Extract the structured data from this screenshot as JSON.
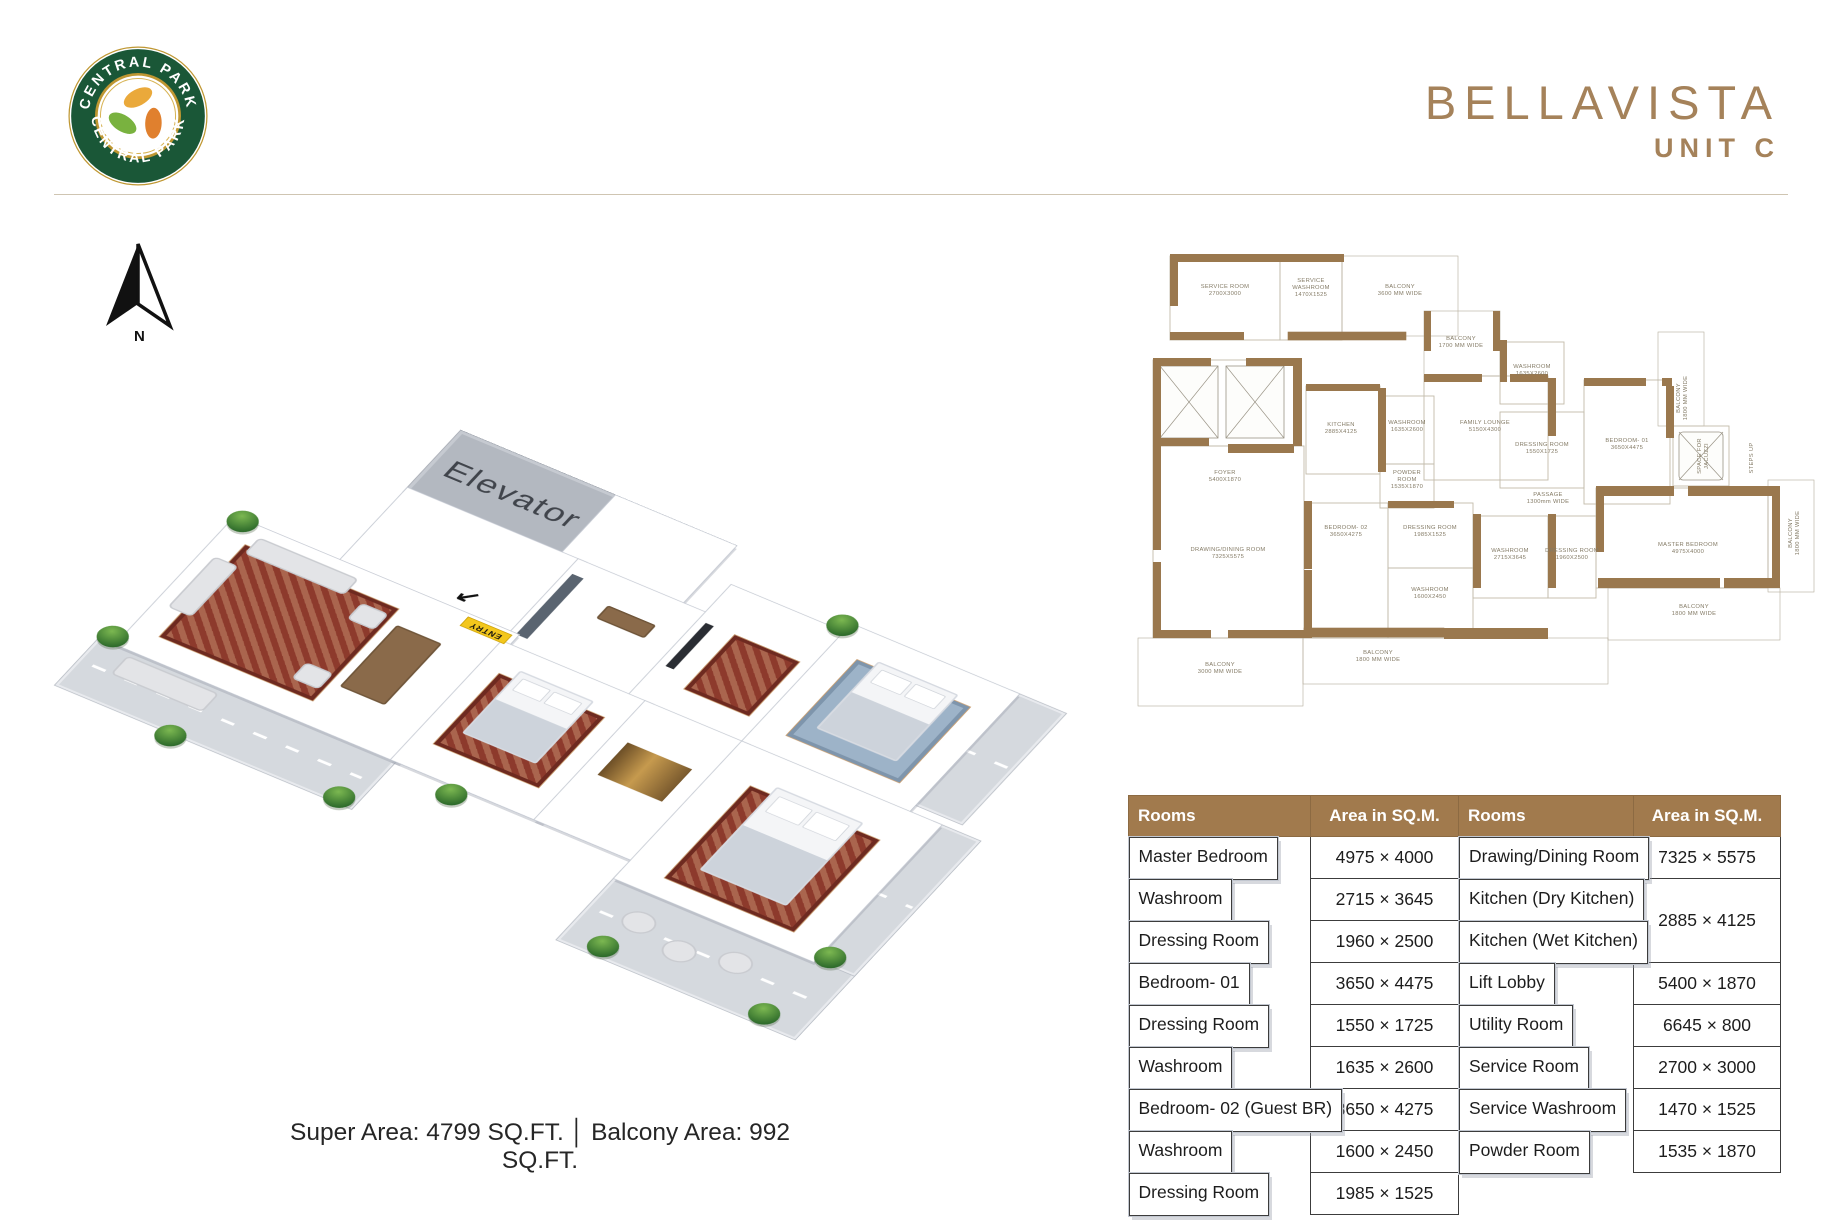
{
  "colors": {
    "accent_tan": "#a5825a",
    "table_header_brown": "#a17a4d",
    "wall_brown": "#9a784e",
    "entry_yellow": "#f3c71c",
    "logo_green": "#1a5737",
    "logo_gold": "#bf9732"
  },
  "brand": {
    "ring_text_top": "CENTRAL PARK",
    "ring_text_bottom": "CENTRAL PARK"
  },
  "header": {
    "title": "BELLAVISTA",
    "subtitle": "UNIT C"
  },
  "compass": {
    "label": "N"
  },
  "iso_plan": {
    "elevator_label": "Elevator",
    "entry_label": "ENTRY",
    "entry_arrow": "↙"
  },
  "floorplan2d": {
    "labels": [
      {
        "lines": [
          "SERVICE ROOM",
          "2700X3000"
        ],
        "x": 97,
        "y": 40
      },
      {
        "lines": [
          "SERVICE",
          "WASHROOM",
          "1470X1525"
        ],
        "x": 183,
        "y": 34
      },
      {
        "lines": [
          "BALCONY",
          "3600 MM WIDE"
        ],
        "x": 272,
        "y": 40
      },
      {
        "lines": [
          "BALCONY",
          "1700 MM WIDE"
        ],
        "x": 333,
        "y": 92
      },
      {
        "lines": [
          "FOYER",
          "5400X1870"
        ],
        "x": 97,
        "y": 226
      },
      {
        "lines": [
          "KITCHEN",
          "2885X4125"
        ],
        "x": 213,
        "y": 178
      },
      {
        "lines": [
          "WASHROOM",
          "1635X2600"
        ],
        "x": 279,
        "y": 176
      },
      {
        "lines": [
          "POWDER",
          "ROOM",
          "1535X1870"
        ],
        "x": 279,
        "y": 226
      },
      {
        "lines": [
          "FAMILY LOUNGE",
          "5150X4300"
        ],
        "x": 357,
        "y": 176
      },
      {
        "lines": [
          "WASHROOM",
          "1635X2600"
        ],
        "x": 404,
        "y": 120
      },
      {
        "lines": [
          "DRESSING ROOM",
          "1550X1725"
        ],
        "x": 414,
        "y": 198
      },
      {
        "lines": [
          "BEDROOM- 01",
          "3650X4475"
        ],
        "x": 499,
        "y": 194
      },
      {
        "lines": [
          "BALCONY",
          "1800 MM WIDE"
        ],
        "x": 552,
        "y": 150,
        "rot": -90
      },
      {
        "lines": [
          "SPACE FOR",
          "JACUZZI"
        ],
        "x": 573,
        "y": 208,
        "rot": -90
      },
      {
        "lines": [
          "STEPS UP"
        ],
        "x": 625,
        "y": 210,
        "rot": -90
      },
      {
        "lines": [
          "PASSAGE",
          "1300mm WIDE"
        ],
        "x": 420,
        "y": 248
      },
      {
        "lines": [
          "DRAWING/DINING ROOM",
          "7325X5575"
        ],
        "x": 100,
        "y": 303
      },
      {
        "lines": [
          "BEDROOM- 02",
          "3650X4275"
        ],
        "x": 218,
        "y": 281
      },
      {
        "lines": [
          "DRESSING ROOM",
          "1985X1525"
        ],
        "x": 302,
        "y": 281
      },
      {
        "lines": [
          "WASHROOM",
          "1600X2450"
        ],
        "x": 302,
        "y": 343
      },
      {
        "lines": [
          "WASHROOM",
          "2715X3645"
        ],
        "x": 382,
        "y": 304
      },
      {
        "lines": [
          "DRESSING ROOM",
          "1960X2500"
        ],
        "x": 444,
        "y": 304
      },
      {
        "lines": [
          "MASTER BEDROOM",
          "4975X4000"
        ],
        "x": 560,
        "y": 298
      },
      {
        "lines": [
          "BALCONY",
          "1800 MM WIDE"
        ],
        "x": 250,
        "y": 406
      },
      {
        "lines": [
          "BALCONY",
          "3000 MM WIDE"
        ],
        "x": 92,
        "y": 418
      },
      {
        "lines": [
          "BALCONY",
          "1800 MM WIDE"
        ],
        "x": 566,
        "y": 360
      },
      {
        "lines": [
          "BALCONY",
          "1800 MM WIDE"
        ],
        "x": 664,
        "y": 285,
        "rot": -90
      }
    ]
  },
  "area_table": {
    "headers": [
      "Rooms",
      "Area in SQ.M.",
      "Rooms",
      "Area in SQ.M."
    ],
    "rows": [
      {
        "l_room": "Master Bedroom",
        "l_area": "4975 × 4000",
        "r_room": "Drawing/Dining Room",
        "r_area": "7325 × 5575"
      },
      {
        "l_room": "Washroom",
        "l_area": "2715 × 3645",
        "r_room": "Kitchen (Dry Kitchen)",
        "r_area": "2885 × 4125",
        "r_span": 2
      },
      {
        "l_room": "Dressing Room",
        "l_area": "1960 × 2500",
        "r_room": "Kitchen (Wet Kitchen)",
        "r_area": null
      },
      {
        "l_room": "Bedroom- 01",
        "l_area": "3650 × 4475",
        "r_room": "Lift Lobby",
        "r_area": "5400 × 1870"
      },
      {
        "l_room": "Dressing Room",
        "l_area": "1550 × 1725",
        "r_room": "Utility Room",
        "r_area": "6645 × 800"
      },
      {
        "l_room": "Washroom",
        "l_area": "1635 × 2600",
        "r_room": "Service Room",
        "r_area": "2700 × 3000"
      },
      {
        "l_room": "Bedroom- 02 (Guest BR)",
        "l_area": "3650 × 4275",
        "r_room": "Service Washroom",
        "r_area": "1470 × 1525"
      },
      {
        "l_room": "Washroom",
        "l_area": "1600 × 2450",
        "r_room": "Powder Room",
        "r_area": "1535 × 1870"
      },
      {
        "l_room": "Dressing Room",
        "l_area": "1985 × 1525",
        "r_room": null,
        "r_area": null
      }
    ]
  },
  "footer": {
    "super_area": "Super Area: 4799 SQ.FT.",
    "separator": "│",
    "balcony_area": "Balcony Area: 992 SQ.FT."
  }
}
